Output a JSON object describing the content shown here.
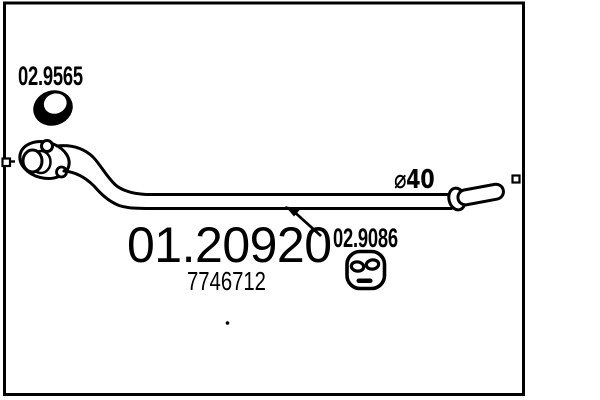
{
  "page": {
    "background": "#ffffff",
    "line_color": "#000000"
  },
  "part": {
    "main_number": "01.20920",
    "oe_reference": "7746712"
  },
  "components": {
    "gasket_label": "02.9565",
    "mount_label": "02.9086",
    "diameter_label": "⌀40"
  }
}
